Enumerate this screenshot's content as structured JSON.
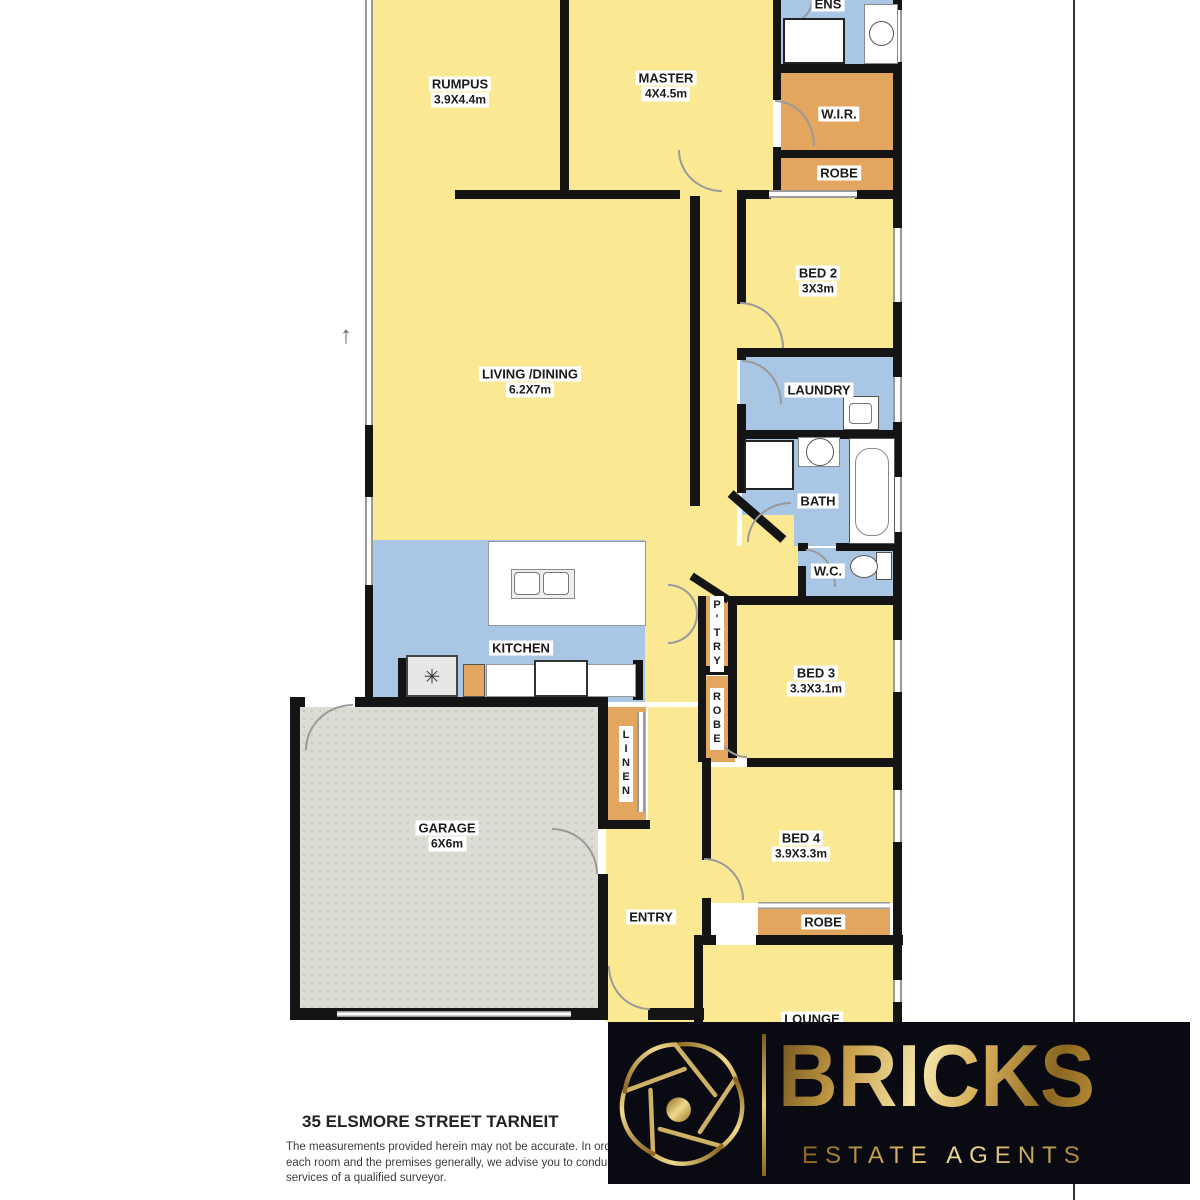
{
  "plan": {
    "north_arrow_glyph": "↑",
    "fridge_glyph": "✳",
    "colors": {
      "room_yellow": "#FAE992",
      "wet_blue": "#A9C6E4",
      "storage_orange": "#E2A65F",
      "garage_grey": "#DCDCD5",
      "wall": "#141414",
      "brand_gold": "#C9A04A",
      "band_background": "#0A0A13"
    },
    "rooms": {
      "rumpus": {
        "label": "RUMPUS",
        "dims": "3.9X4.4m"
      },
      "master": {
        "label": "MASTER",
        "dims": "4X4.5m"
      },
      "ens": {
        "label": "ENS"
      },
      "wir": {
        "label": "W.I.R."
      },
      "robe_master": {
        "label": "ROBE"
      },
      "bed2": {
        "label": "BED 2",
        "dims": "3X3m"
      },
      "living": {
        "label": "LIVING /DINING",
        "dims": "6.2X7m"
      },
      "laundry": {
        "label": "LAUNDRY"
      },
      "bath": {
        "label": "BATH"
      },
      "wc": {
        "label": "W.C."
      },
      "kitchen": {
        "label": "KITCHEN"
      },
      "pantry": {
        "label": "P'TRY"
      },
      "robe_bed3": {
        "label": "ROBE"
      },
      "bed3": {
        "label": "BED 3",
        "dims": "3.3X3.1m"
      },
      "linen": {
        "label": "LINEN"
      },
      "garage": {
        "label": "GARAGE",
        "dims": "6X6m"
      },
      "entry": {
        "label": "ENTRY"
      },
      "bed4": {
        "label": "BED 4",
        "dims": "3.9X3.3m"
      },
      "robe_bed4": {
        "label": "ROBE"
      },
      "lounge": {
        "label": "LOUNGE"
      }
    }
  },
  "footer": {
    "address": "35 ELSMORE STREET TARNEIT",
    "disclaimer": {
      "line1": "The measurements provided herein may not be accurate. In order",
      "line2": "each room and the premises generally, we advise you to conduct",
      "line3": "services of a qualified surveyor."
    }
  },
  "brand": {
    "name": "BRICKS",
    "tagline": "ESTATE AGENTS"
  }
}
